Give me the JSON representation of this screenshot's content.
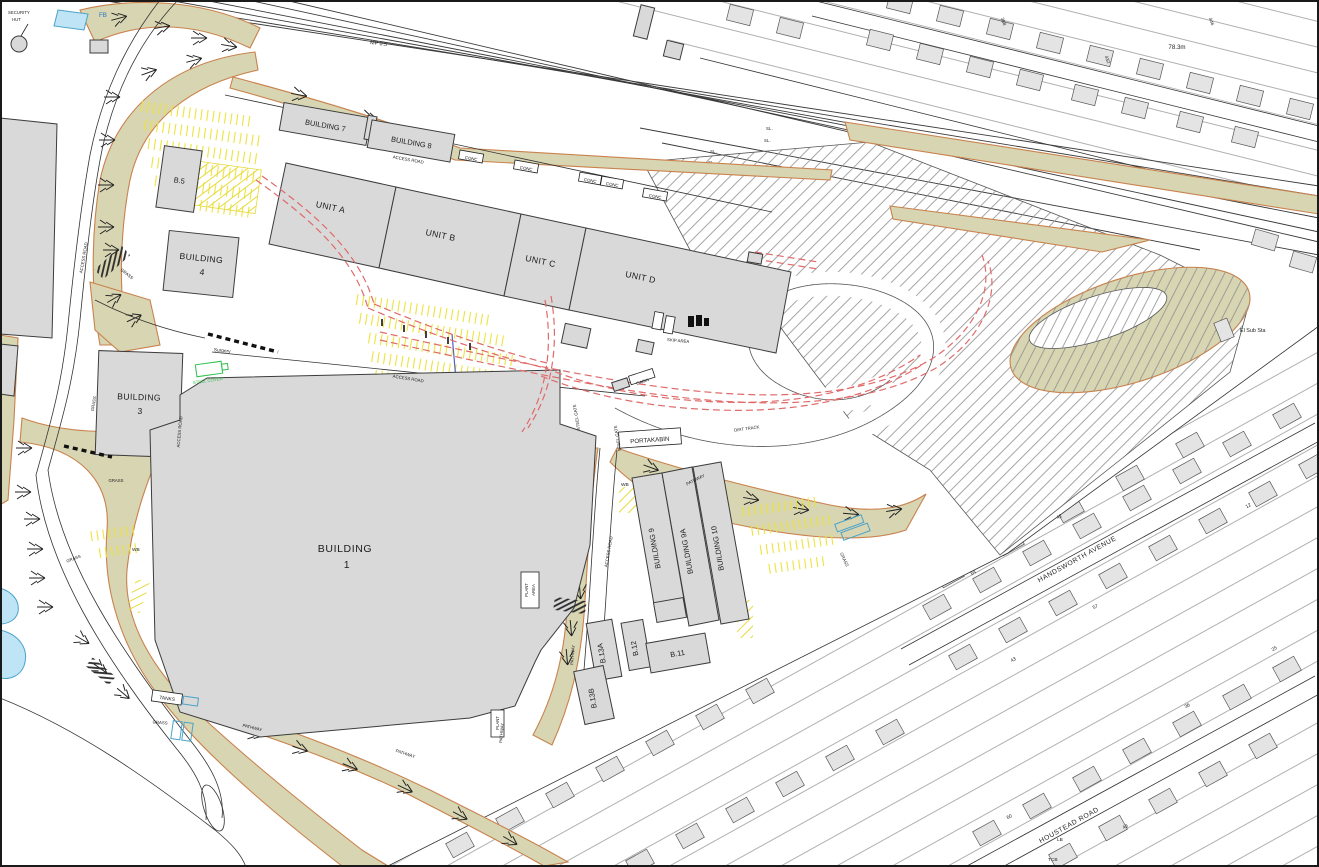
{
  "title": "Industrial estate site plan",
  "labels": {
    "security_line1": "SECURITY",
    "security_line2": "HUT",
    "fb": "FB",
    "mp": "MP 0.5",
    "sl": "SL .",
    "spot_height": "78.3m",
    "el_sub_sta": "El Sub Sta",
    "handsworth_avenue": "HANDSWORTH AVENUE",
    "houstead_road": "HOUSTEAD ROAD",
    "lb": "LB",
    "tcb": "TCB",
    "access_road": "ACCESS ROAD",
    "grass": "GRASS",
    "pathway": "PATHWAY",
    "conc": "CONC",
    "cabin": "CABIN",
    "portakabin": "PORTAKABIN",
    "dirt_track": "DIRT TRACK",
    "skip_area": "SKIP AREA",
    "surgery": "Surgery",
    "steel_cover": "STEEL COVER",
    "steel_gate": "STEEL GATE",
    "wb": "WB",
    "tanks": "TANKS",
    "plant": "PLANT",
    "area": "AREA"
  },
  "buildings": {
    "b7": "BUILDING 7",
    "b8": "BUILDING 8",
    "b5": "B.5",
    "b4_1": "BUILDING",
    "b4_2": "4",
    "b3_1": "BUILDING",
    "b3_2": "3",
    "b1_1": "BUILDING",
    "b1_2": "1",
    "unit_a": "UNIT A",
    "unit_b": "UNIT B",
    "unit_c": "UNIT C",
    "unit_d": "UNIT D",
    "b9": "BUILDING 9",
    "b9a": "BUILDING 9A",
    "b10": "BUILDING 10",
    "b13a": "B.13A",
    "b12": "B.12",
    "b11": "B.11",
    "b13b": "B.13B"
  },
  "house_numbers": [
    "388",
    "432",
    "446",
    "42",
    "64",
    "12",
    "57",
    "43",
    "25",
    "36",
    "60",
    "49"
  ],
  "colors": {
    "vegetation": "#d8d5b2",
    "vegetation_edge": "#c9824d",
    "building_fill": "#d9d9d9",
    "house_fill": "#e4e4e4",
    "parking_yellow": "#ece23c",
    "route_red": "#e06a6a",
    "water_blue": "#bfe4f5",
    "water_edge": "#4aa3c8",
    "steel_green": "#2fbf4f",
    "fb_blue": "#2277cc"
  }
}
